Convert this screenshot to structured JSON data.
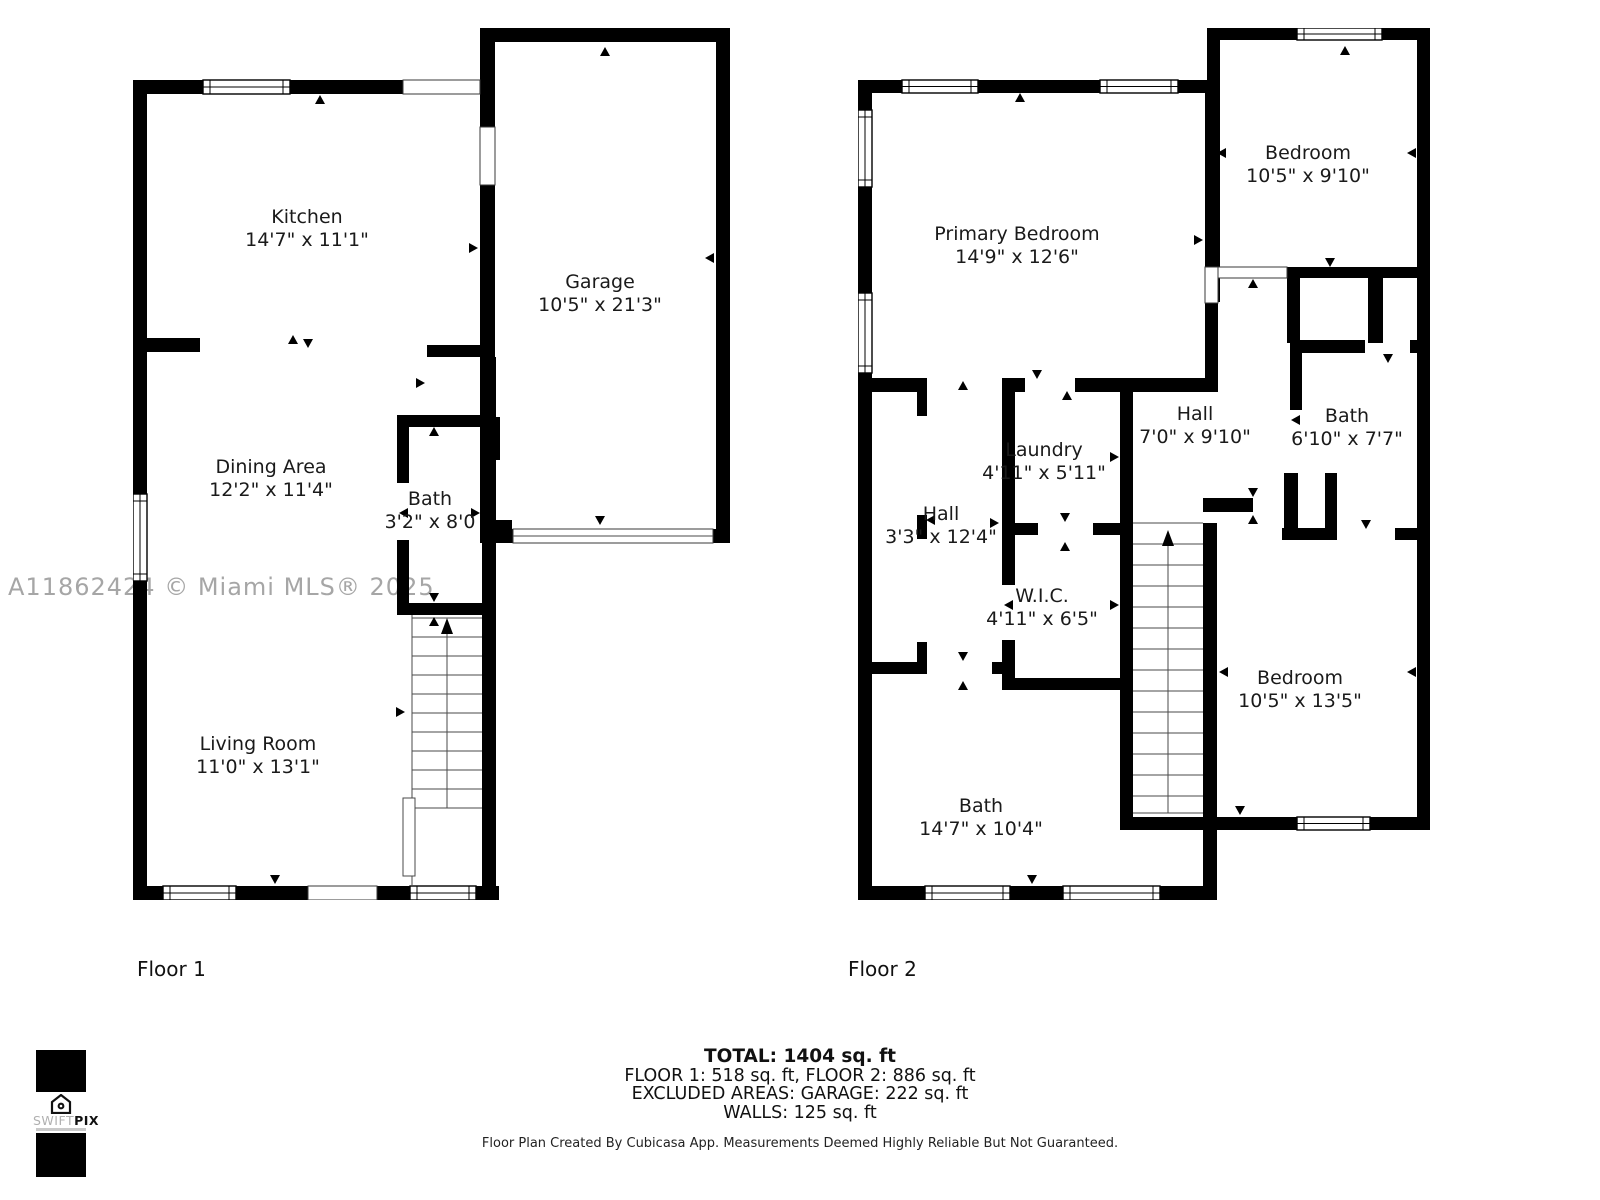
{
  "watermark": "A11862424 © Miami MLS® 2025",
  "floor1": {
    "label": "Floor 1",
    "rooms": [
      {
        "name": "Kitchen",
        "dims": "14'7\" x 11'1\""
      },
      {
        "name": "Garage",
        "dims": "10'5\" x 21'3\""
      },
      {
        "name": "Dining Area",
        "dims": "12'2\" x 11'4\""
      },
      {
        "name": "Bath",
        "dims": "3'2\" x 8'0"
      },
      {
        "name": "Living Room",
        "dims": "11'0\" x 13'1\""
      }
    ]
  },
  "floor2": {
    "label": "Floor 2",
    "rooms": [
      {
        "name": "Primary Bedroom",
        "dims": "14'9\" x 12'6\""
      },
      {
        "name": "Bedroom",
        "dims": "10'5\" x 9'10\""
      },
      {
        "name": "Hall",
        "dims": "7'0\" x 9'10\""
      },
      {
        "name": "Bath",
        "dims": "6'10\" x 7'7\""
      },
      {
        "name": "Laundry",
        "dims": "4'11\" x 5'11\""
      },
      {
        "name": "Hall",
        "dims": "3'3\" x 12'4\""
      },
      {
        "name": "W.I.C.",
        "dims": "4'11\" x 6'5\""
      },
      {
        "name": "Bedroom",
        "dims": "10'5\" x 13'5\""
      },
      {
        "name": "Bath",
        "dims": "14'7\" x 10'4\""
      }
    ]
  },
  "summary": {
    "total": "TOTAL: 1404 sq. ft",
    "floors": "FLOOR 1: 518 sq. ft, FLOOR 2: 886 sq. ft",
    "excluded": "EXCLUDED AREAS: GARAGE: 222 sq. ft",
    "walls": "WALLS: 125 sq. ft"
  },
  "disclaimer": "Floor Plan Created By Cubicasa App. Measurements Deemed Highly Reliable But Not Guaranteed.",
  "logo": {
    "brand_light": "SWIFT",
    "brand_bold": "PIX",
    "icon": "house-icon"
  },
  "colors": {
    "wall": "#000000",
    "text": "#1a1a1a",
    "watermark": "#a6a6a6",
    "background": "#ffffff"
  }
}
